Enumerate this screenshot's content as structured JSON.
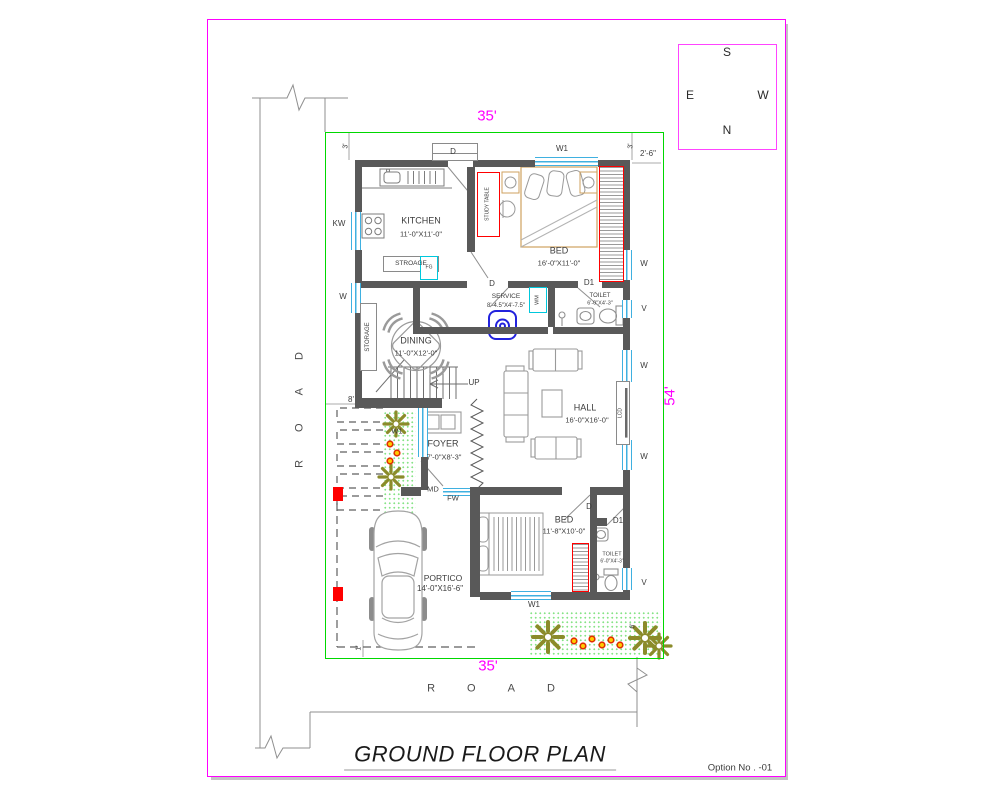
{
  "sheet": {
    "title": "GROUND FLOOR PLAN",
    "option_no": "Option No . -01"
  },
  "compass": {
    "top": "S",
    "bottom": "N",
    "left": "E",
    "right": "W"
  },
  "site": {
    "width_top": "35'",
    "width_bottom": "35'",
    "depth_right": "54'",
    "setback_left": "3'",
    "setback_right": "3'",
    "offset_top_right": "2'-6\"",
    "stair_width": "8'",
    "portico_offset": "1'",
    "garden_depth": "6'",
    "road_left": "ROAD",
    "road_bottom": "ROAD"
  },
  "rooms": {
    "kitchen": {
      "name": "KITCHEN",
      "size": "11'-0\"X11'-0\""
    },
    "bed1": {
      "name": "BED",
      "size": "16'-0\"X11'-0\""
    },
    "service": {
      "name": "SERVICE",
      "size": "8'-4.5\"X4'-7.5\""
    },
    "toilet1": {
      "name": "TOILET",
      "size": "6'-0\"X4'-3\""
    },
    "dining": {
      "name": "DINING",
      "size": "11'-0\"X12'-0\""
    },
    "hall": {
      "name": "HALL",
      "size": "16'-0\"X16'-0\""
    },
    "foyer": {
      "name": "FOYER",
      "size": "7'-0\"X8'-3\""
    },
    "bed2": {
      "name": "BED",
      "size": "11'-8\"X10'-0\""
    },
    "toilet2": {
      "name": "TOILET",
      "size": "6'-0\"X4'-3\""
    },
    "portico": {
      "name": "PORTICO",
      "size": "14'-0\"X16'-6\""
    }
  },
  "openings": {
    "window": "W",
    "window_wide": "W1",
    "kitchen_window": "KW",
    "ventilator": "V",
    "door": "D",
    "door_small": "D1",
    "main_door": "MD",
    "french_window": "FW"
  },
  "fixtures": {
    "storage_shelf": "STROAGE",
    "storage_unit": "STORAGE",
    "study_table": "STUDY TABLE",
    "fridge": "FG",
    "washing_machine": "WM",
    "tv_unit": "LCD",
    "stair_direction": "UP"
  },
  "colors": {
    "boundary_green": "#00d800",
    "dimension_magenta": "#ff00ff",
    "wall_gray": "#595959",
    "window_blue": "#3fb0e0",
    "accent_red": "#ff0000",
    "fixture_cyan": "#00c8dc",
    "plant_olive": "#8b8b2a",
    "appliance_blue": "#2222dd"
  }
}
